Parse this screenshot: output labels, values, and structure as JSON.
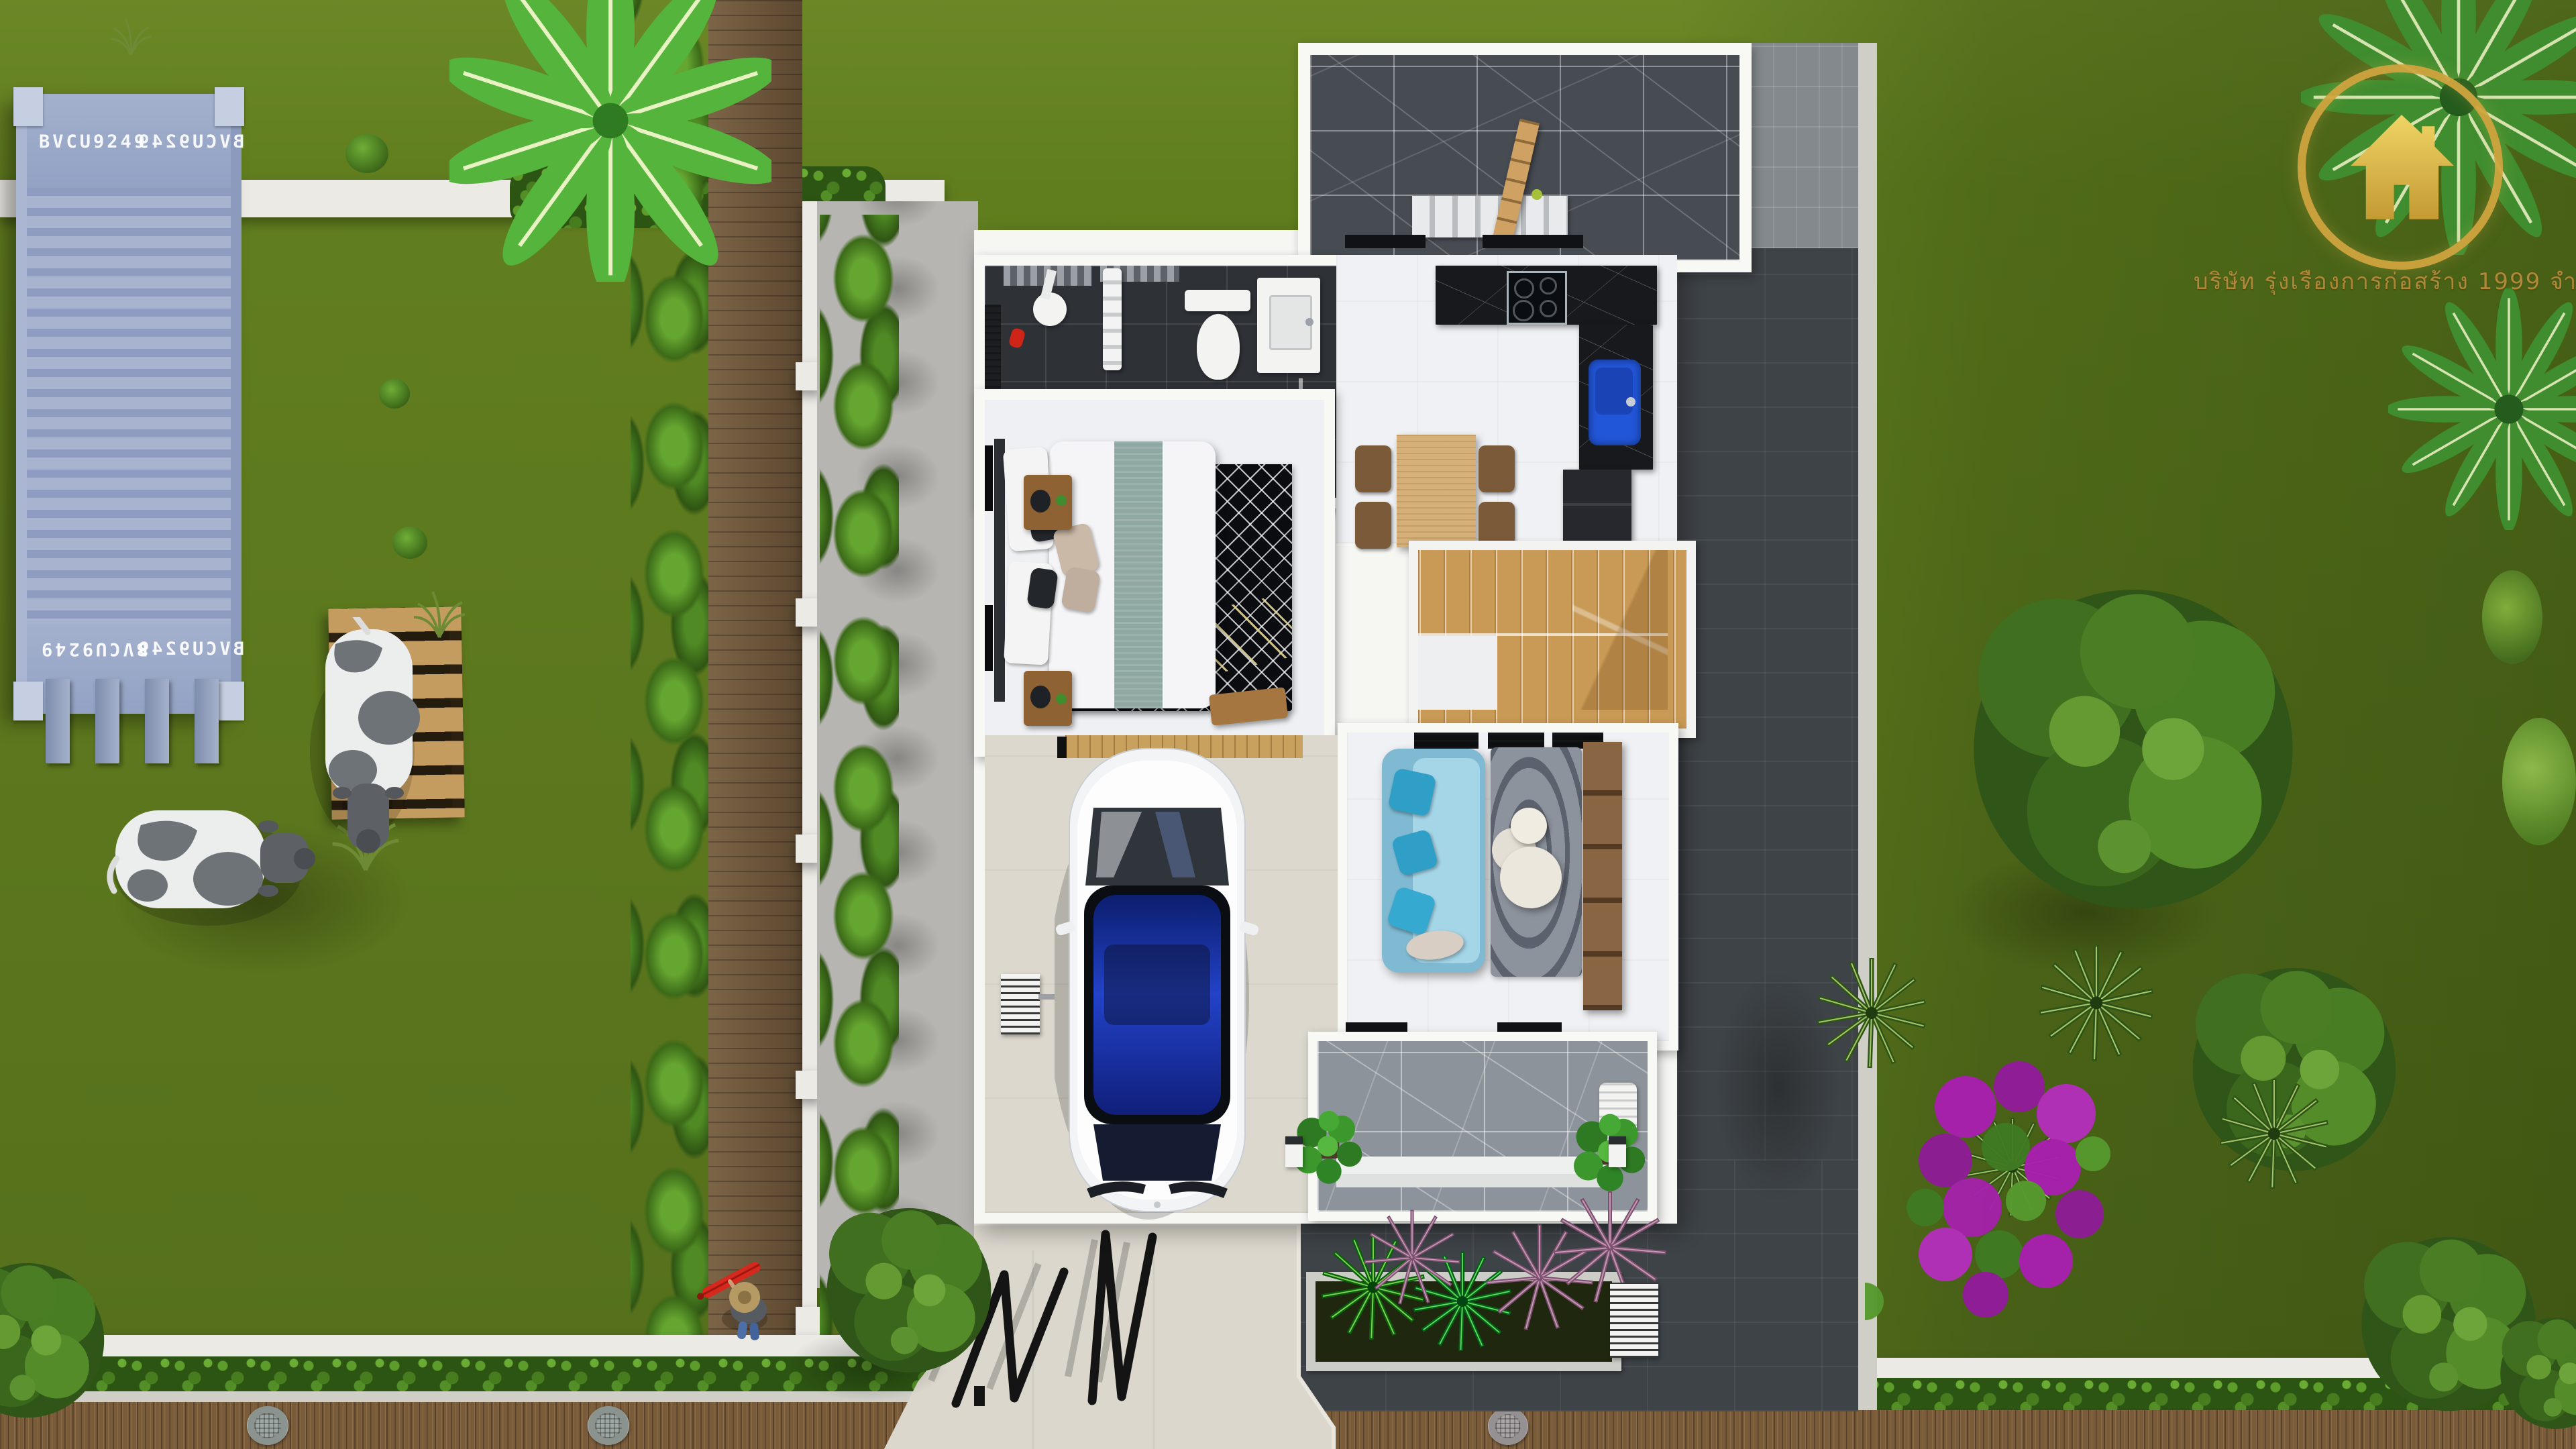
{
  "branding": {
    "logo_icon": "gold-house-in-ring-logo",
    "company_text": "บริษัท รุ่งเรืองการก่อสร้าง 1999 จำกัด"
  },
  "container": {
    "code": "BVCU9249"
  },
  "palette": {
    "lawn_green": "#5e7a1d",
    "lawn_dark": "#49611a",
    "container_blue": "#98a7c7",
    "walkway_wood": "#6d5539",
    "pallet_wood": "#c59c5f",
    "driveway_concrete": "#dbd7cd",
    "side_concrete": "#b6b5b1",
    "charcoal_paver": "#3e4347",
    "porch_marble_gray": "#8d939a",
    "bathroom_tile": "#2e3237",
    "kitchen_counter_black": "#17191d",
    "kitchen_sink_blue": "#2256d8",
    "stair_wood": "#c89a55",
    "sofa_blue": "#8fc8de",
    "pillow_teal": "#2f9fc7",
    "rug_black": "#0b0c0f",
    "rug_gold": "#d8c878",
    "bougainvillea_magenta": "#a81fae",
    "logo_gold": "#d0a43e",
    "umbrella_red": "#d6281c",
    "cow_patch_gray": "#6e7377"
  },
  "scene_objects": [
    "lawn",
    "shipping-container",
    "wooden-pallet",
    "grazing-cow",
    "standing-cow",
    "banana-palm",
    "palm-tree",
    "boundary-wall",
    "hedge",
    "wood-plank-walkway",
    "fence-posts",
    "house",
    "rear-terrace",
    "terrace-bench",
    "wooden-ladder",
    "bathroom",
    "toilet",
    "shower",
    "vanity-sink",
    "bedroom",
    "double-bed",
    "nightstand",
    "geometric-rug",
    "kitchen",
    "induction-cooktop",
    "blue-sink",
    "refrigerator",
    "dining-table",
    "u-shaped-staircase",
    "living-room",
    "blue-sofa",
    "round-coffee-tables",
    "tv-console",
    "carport",
    "white-car",
    "air-conditioner-unit",
    "front-porch",
    "potted-monstera",
    "porch-lamp",
    "outdoor-chair",
    "driveway",
    "folding-gate",
    "planter-box",
    "cordyline-plants",
    "bougainvillea",
    "large-tree",
    "yucca",
    "person-with-red-umbrella",
    "manhole-cover",
    "company-logo"
  ]
}
